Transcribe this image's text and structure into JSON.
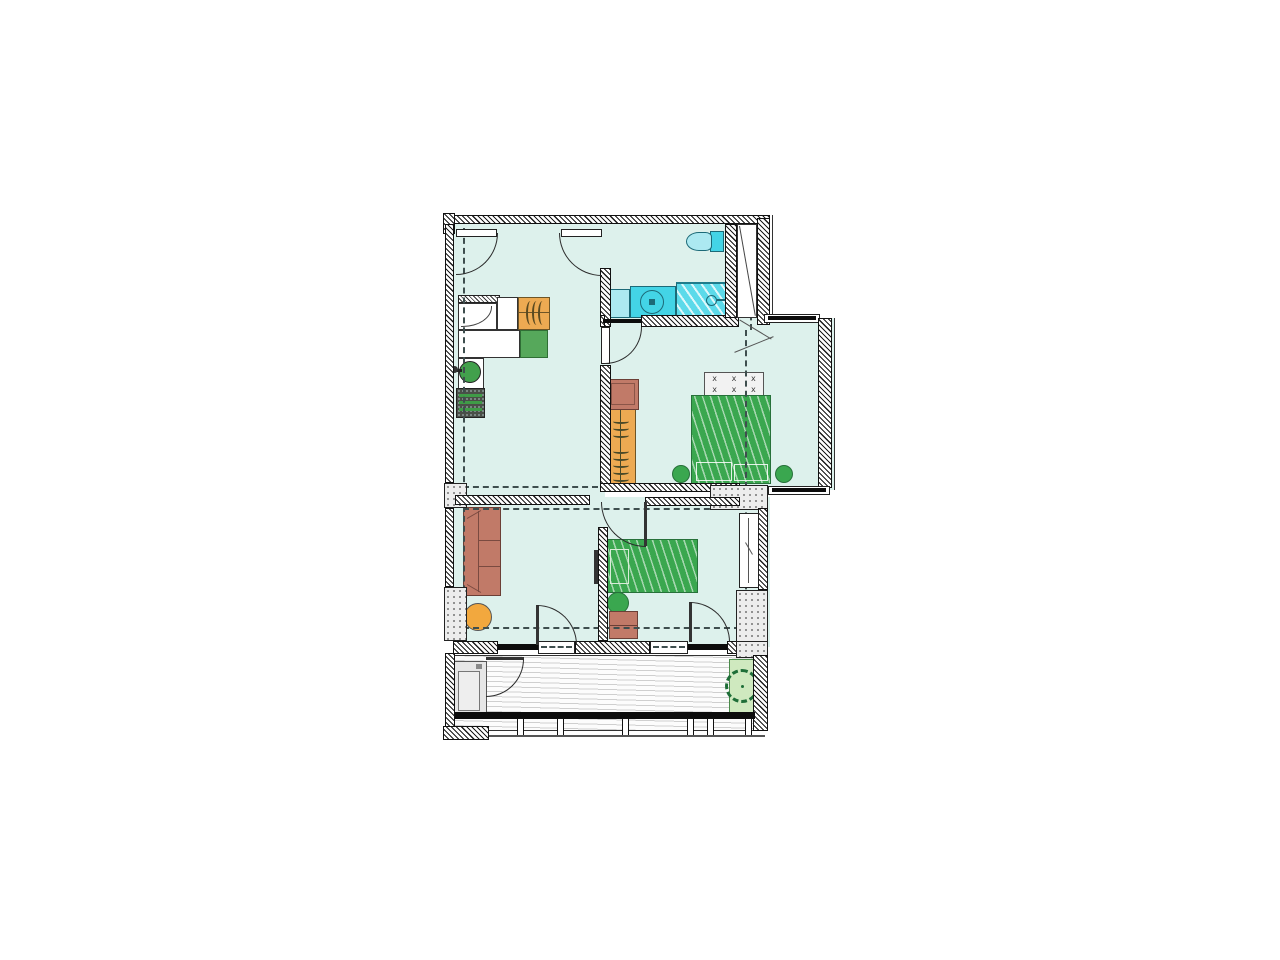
{
  "meta": {
    "title": "apartment-floor-plan",
    "canvas": "1280x960"
  },
  "colors": {
    "floor": "#ddf1ec",
    "accentGreen": "#3aa74f",
    "greenDark": "#27713a",
    "orangeWood": "#edaa52",
    "woodDark": "#6e5526",
    "terracotta": "#c17a68",
    "terracottaDark": "#6b3f36",
    "cyanFixture": "#43d4e6",
    "cyanLight": "#ace9f1",
    "cyanShower": "#5cdaea",
    "cyanDark": "#1c6a78",
    "ottoman": "#f2a83e",
    "kitchenGreen": "#56a85b",
    "stoveGray": "#4a4f48",
    "deckLine": "#cfcfcf",
    "planter": "#cfe9bf",
    "treeGreen": "#1e6e38",
    "dash": "#3e4e4e",
    "column": "#ededed"
  },
  "glyphs": {
    "pillow_mark": "x"
  },
  "inventory": {
    "rooms": [
      "hall-kitchen",
      "bathroom",
      "bedroom-double",
      "bedroom-single",
      "living-area",
      "balcony",
      "duct-shaft"
    ],
    "furniture": [
      "fridge",
      "kitchen-counter",
      "kitchen-cabinet",
      "kitchen-sink",
      "stove",
      "sofa",
      "ottoman",
      "wardrobe",
      "wardrobe-top-cabinet",
      "double-bed",
      "pillow-shelf",
      "pouf",
      "pouf",
      "single-bed",
      "pouf",
      "nightstand",
      "wall-tv",
      "toilet",
      "washing-machine",
      "bathroom-sink",
      "shower",
      "balcony-cabinet",
      "planter-tree"
    ],
    "doors": [
      "entry-door-left",
      "entry-door-right",
      "bathroom-door",
      "single-bedroom-door",
      "living-balcony-door",
      "bedroom-balcony-door"
    ]
  }
}
